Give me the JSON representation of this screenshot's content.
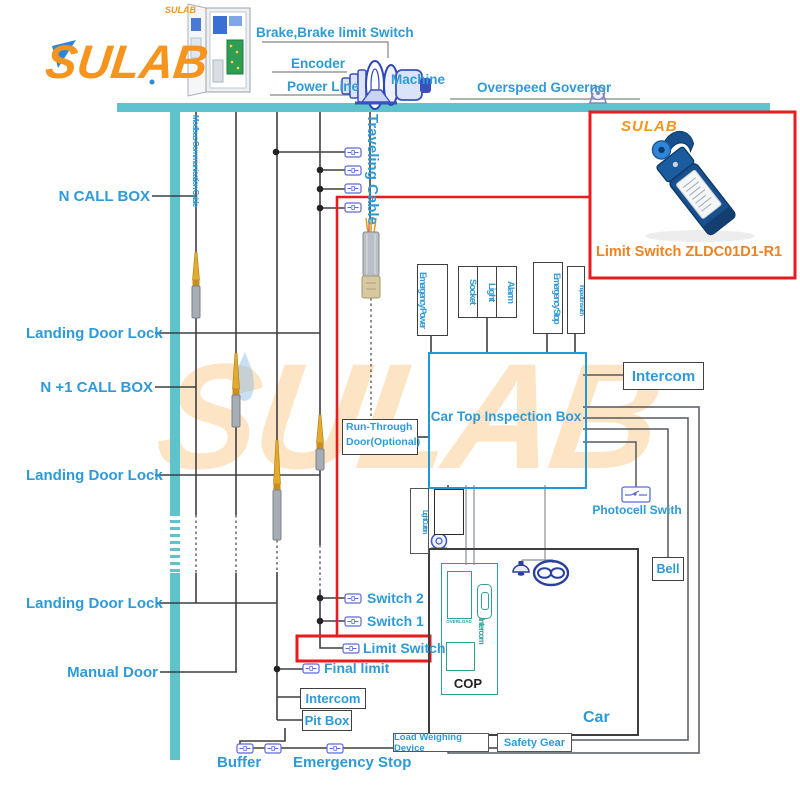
{
  "colors": {
    "accent_blue": "#2e9ad7",
    "teal_rail": "#5fc3cd",
    "wire_black": "#3f3f3f",
    "highlight_red": "#e81c1c",
    "brand_orange": "#f7941d",
    "switch_blue": "#5b6bd5",
    "cop_teal": "#2ba396"
  },
  "logo": {
    "main": "SULAB",
    "cabinet_caption": "SULAB",
    "watermark": "SULAB"
  },
  "machine_room": {
    "brake": "Brake,Brake limit Switch",
    "encoder": "Encoder",
    "power_line": "Power Line",
    "machine": "Machine",
    "overspeed_governor": "Overspeed Governor"
  },
  "cables": {
    "modbus": "Modbus Communication Cable",
    "traveling": "Traveling Cable"
  },
  "left_labels": {
    "n_call_box": "N CALL BOX",
    "landing_door_lock_1": "Landing Door Lock",
    "n_plus1_call_box": "N +1 CALL BOX",
    "landing_door_lock_2": "Landing Door Lock",
    "landing_door_lock_3": "Landing Door Lock",
    "manual_door": "Manual Door"
  },
  "car_top_box": {
    "title": "Car Top Inspection Box",
    "ports": {
      "emergency_power": "Emergency Power",
      "socket": "Socket",
      "light": "Light",
      "alarm": "Alarm",
      "emergency_stop": "Emergency Stop",
      "inspection_switch": "Inspection switch"
    },
    "run_through_door_1": "Run-Through",
    "run_through_door_2": "Door(Optional)",
    "light_curtain": "Light Curtain"
  },
  "right_devices": {
    "intercom": "Intercom",
    "photocell": "Photocell Swith",
    "bell": "Bell"
  },
  "car": {
    "label": "Car",
    "cop": "COP",
    "cop_overload": "OVERLOAD",
    "cop_intercom": "Intercom",
    "load_weighing_device": "Load Weighing Device",
    "safety_gear": "Safety Gear"
  },
  "pit": {
    "switch_2": "Switch 2",
    "switch_1": "Switch 1",
    "limit_switch": "Limit Switch",
    "final_limit": "Final limit",
    "intercom": "Intercom",
    "pit_box": "Pit Box",
    "buffer": "Buffer",
    "emergency_stop": "Emergency Stop"
  },
  "callout": {
    "brand": "SULAB",
    "caption": "Limit Switch ZLDC01D1-R1"
  }
}
